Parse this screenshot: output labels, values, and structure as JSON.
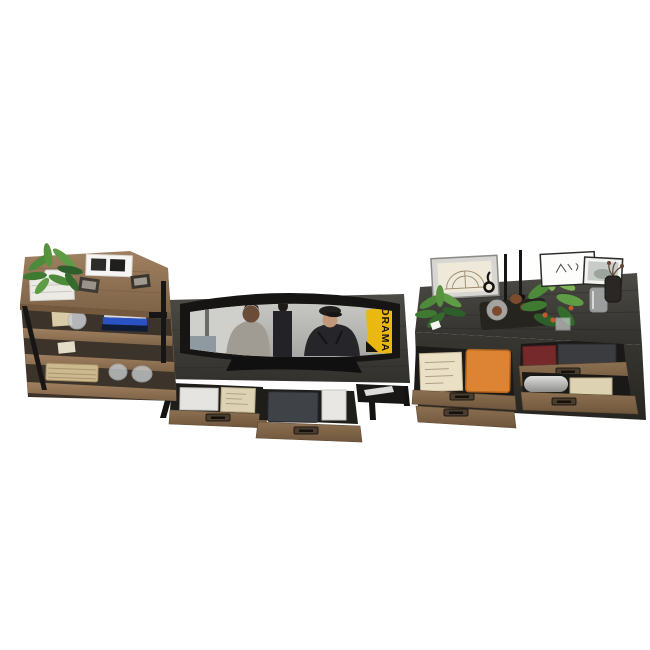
{
  "scene": {
    "title": "Industrial living-room furniture set, high-angle 3D product render on white",
    "units": [
      "rustic wood open bookshelf with black metal frame",
      "dark charcoal TV stand with curved television and two pulled-out drawers",
      "dark charcoal sideboard with four drawers (two open) and decor on top"
    ]
  },
  "colors": {
    "background": "#ffffff",
    "rustic_wood": "#8d7053",
    "rustic_wood_dark": "#74593f",
    "dark_wood": "#3d3b37",
    "dark_wood_deep": "#262522",
    "metal_black": "#171614",
    "drawer_interior": "#1d1b18",
    "banner_yellow": "#e9b912",
    "banner_text": "#17130b",
    "orange_box": "#dd8434",
    "red_book": "#76292a",
    "cream_paper": "#e9e0c6",
    "white_paper": "#e8e7e3",
    "plant_green": "#4d8a3a",
    "plant_light": "#7fb356",
    "plant_dark": "#2e5e2a",
    "accent_orange": "#c05a2a",
    "glass": "#ccd0d3",
    "screen_bg": "#b9bab6"
  },
  "tv": {
    "banner_text": "DRAMA",
    "screen_content": "movie still: two men talking in a gym",
    "left_actor": "young man in gray t-shirt",
    "right_actor": "older man in black jacket and flat cap"
  },
  "bookshelf": {
    "top_items": [
      "green plant in white pot on white book stack",
      "white double photo frame",
      "two small black photo frames"
    ],
    "shelf_items": [
      "beige envelope",
      "glass sphere vase",
      "stack of blue and navy books",
      "woven seagrass basket",
      "two glass jars"
    ]
  },
  "tv_stand": {
    "left_drawer_items": [
      "white paper stack",
      "kraft document folder"
    ],
    "right_drawer_items": [
      "dark gray laptop",
      "white papers"
    ],
    "side_shelf_item": "white folded paper"
  },
  "sideboard": {
    "top_items": [
      "framed arch sketch",
      "two black taper candles",
      "black spiral candle holder",
      "dark tray with glass jar and pinecones",
      "small green plant with white tag",
      "bushy plant with orange berries",
      "framed line-art sketch",
      "framed misty landscape photo",
      "glass cup",
      "dark glass vase with dried stem"
    ],
    "left_drawer_items": [
      "handwritten cream envelope",
      "orange storage box"
    ],
    "right_top_drawer_items": [
      "dark red book",
      "charcoal boxes"
    ],
    "right_bottom_drawer_items": [
      "silver paper roll",
      "cream box"
    ]
  }
}
